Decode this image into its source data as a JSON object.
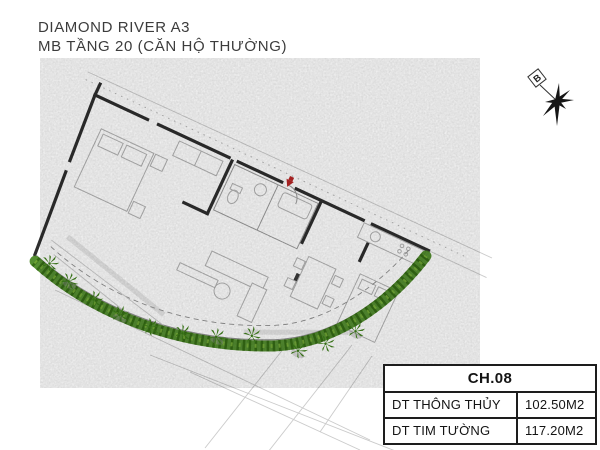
{
  "header": {
    "title_line1": "DIAMOND RIVER A3",
    "title_line2": "MB TẦNG 20 (CĂN HỘ THƯỜNG)"
  },
  "compass": {
    "label": "B"
  },
  "info_table": {
    "header": "CH.08",
    "rows": [
      {
        "label": "DT THÔNG THỦY",
        "value": "102.50M2"
      },
      {
        "label": "DT TIM TƯỜNG",
        "value": "117.20M2"
      }
    ]
  },
  "colors": {
    "text": "#3c3c3c",
    "wall": "#2e2e2e",
    "hedge": "#47861f",
    "hedgeDark": "#2d610f",
    "marker": "#b92626",
    "faint": "#cbcbcb",
    "furn": "#b3b3b3",
    "tableBorder": "#1d1d1d"
  }
}
